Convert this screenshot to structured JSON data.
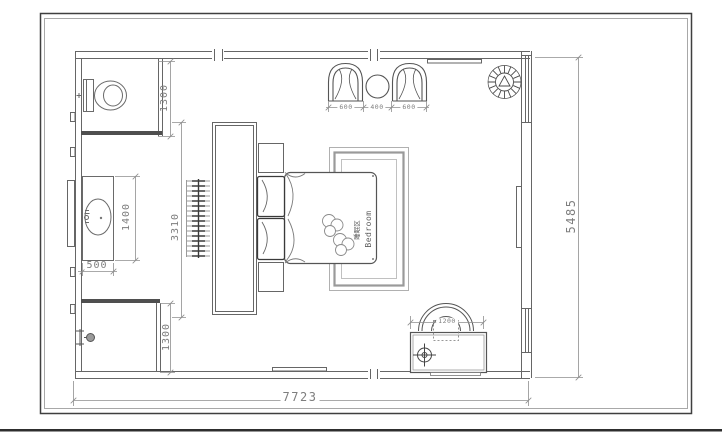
{
  "room": {
    "label_zh": "睡眠区",
    "label_en": "Bedroom"
  },
  "dims": {
    "overall_width": "7723",
    "overall_height": "5485",
    "toilet_zone_depth": "1300",
    "shower_zone_depth": "1300",
    "vanity_length": "1400",
    "vanity_width": "500",
    "wardrobe_length": "3310",
    "armchair_left": "600",
    "tea_table": "400",
    "armchair_right": "600",
    "desk_width": "1200"
  },
  "colors": {
    "wall_line": "#666666",
    "dark_partition": "#4f4f4f",
    "dimension_text": "#7e7e7e",
    "frame": "#3f3f3f"
  }
}
